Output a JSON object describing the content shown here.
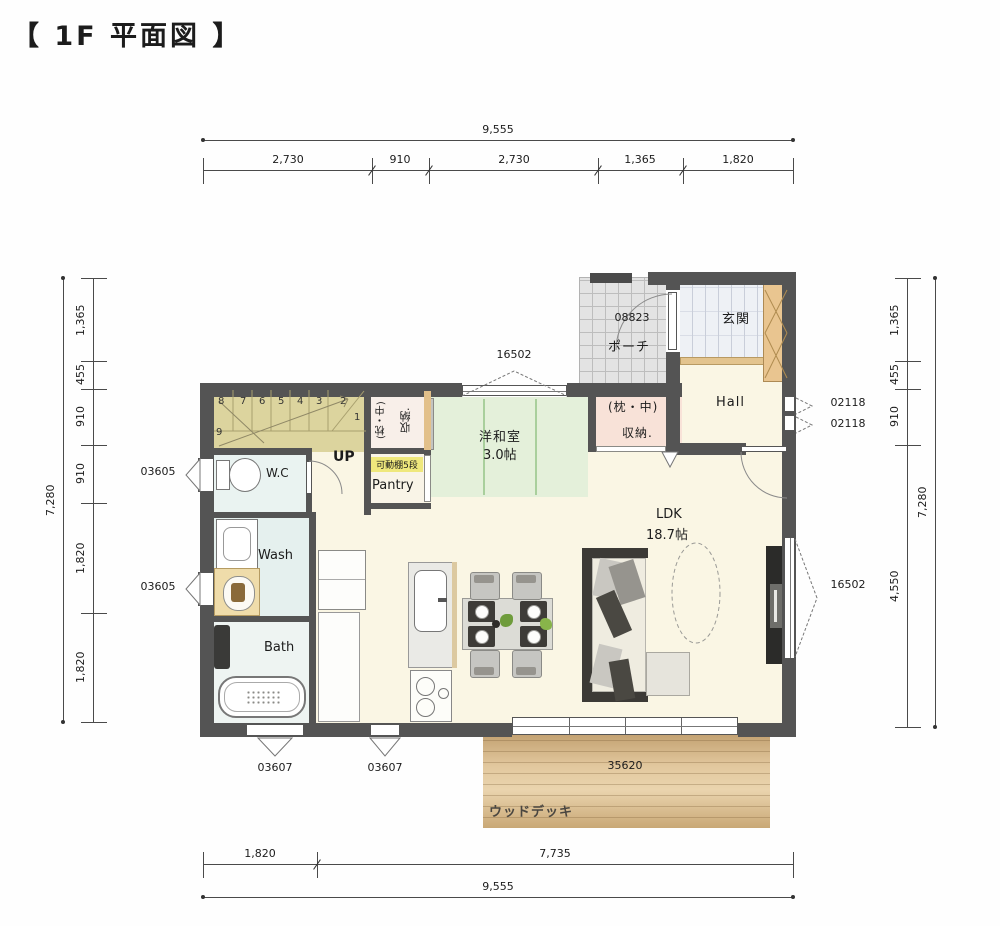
{
  "title": "【 1F 平面図 】",
  "dims": {
    "top_total": "9,555",
    "top_segs": [
      "2,730",
      "910",
      "2,730",
      "1,365",
      "1,820"
    ],
    "bottom_segs": [
      "1,820",
      "7,735"
    ],
    "bottom_total": "9,555",
    "left_total": "7,280",
    "left_segs": [
      "1,365",
      "455",
      "910",
      "910",
      "1,820",
      "1,820"
    ],
    "right_segs": [
      "1,365",
      "455",
      "910",
      "4,550"
    ],
    "right_total": "7,280"
  },
  "openings": {
    "w03605": "03605",
    "w03607": "03607",
    "w02118": "02118",
    "w16502": "16502",
    "w35620": "35620",
    "d08823": "08823"
  },
  "rooms": {
    "porch": "ポーチ",
    "entrance": "玄関",
    "hall": "Hall",
    "closet_hall_l1": "(枕・中)",
    "closet_hall_l2": "収納.",
    "closet_stairs_l1": "(枕・中)",
    "closet_stairs_l2": "収納.",
    "pantry_shelf": "可動棚5段",
    "pantry": "Pantry",
    "up": "UP",
    "wc": "W.C",
    "wash": "Wash",
    "bath": "Bath",
    "tatami_name": "洋和室",
    "tatami_size": "3.0帖",
    "ldk_name": "LDK",
    "ldk_size": "18.7帖",
    "deck": "ウッドデッキ"
  },
  "stairs": {
    "numbers": [
      "8",
      "7",
      "6",
      "5",
      "4",
      "3",
      "2",
      "1",
      "9"
    ]
  },
  "colors": {
    "wall": "#545454",
    "ldk_floor": "#faf6e4",
    "tatami": "#e4f0da",
    "stairs": "#dcd49e",
    "wet_floor": "#e7f2f0",
    "closet_pink": "#f8e2d8",
    "shelf_band": "#efe87c",
    "deck": "#d9b98c",
    "cabinet_tan": "#e9c590"
  }
}
